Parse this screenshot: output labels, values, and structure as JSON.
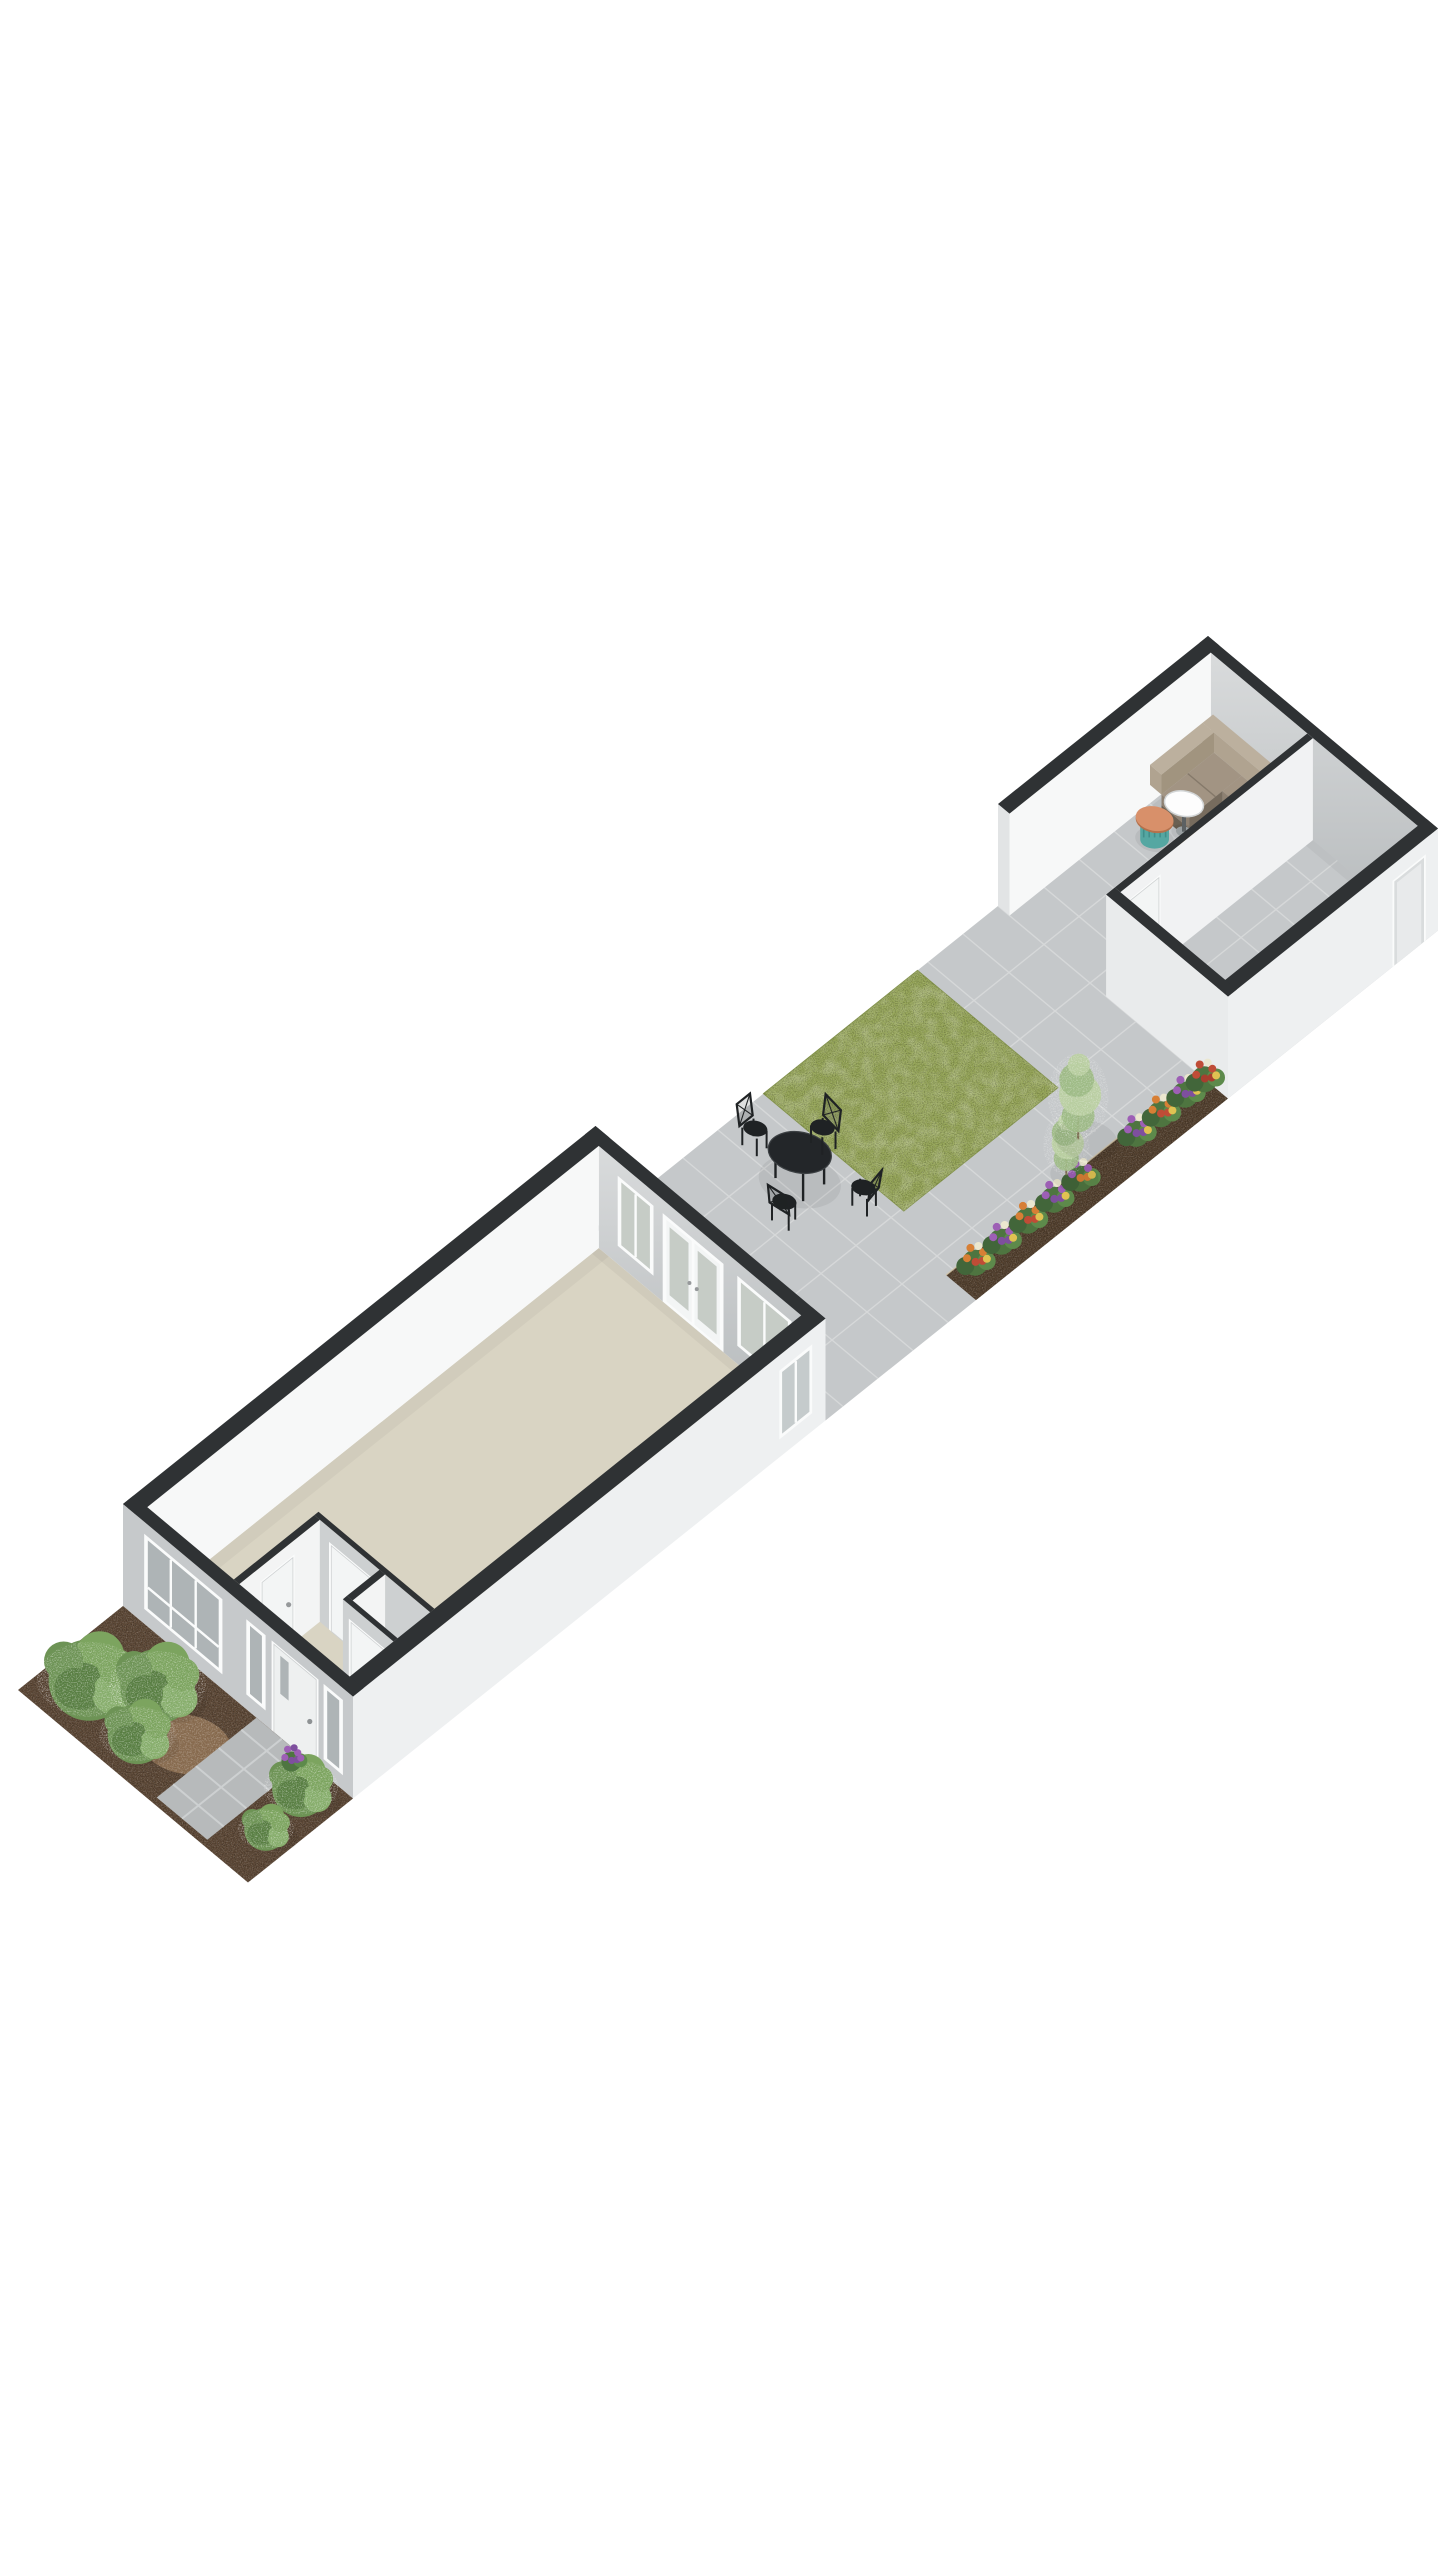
{
  "scene": {
    "background": "#ffffff",
    "projection": {
      "ux": 35,
      "uy": -28,
      "vx": 46,
      "vy": 38.5,
      "hz": 40,
      "ox": 18,
      "oy": 1690,
      "discRx": 58,
      "discRy": 37,
      "discRot": 11
    },
    "render": {
      "wallHeight": 2.55,
      "extWall": 0.3,
      "intWall": 0.12,
      "ghWall": 0.25
    },
    "palette": {
      "cap": "#2f3234",
      "faceFront": "#c6c9cb",
      "faceWhite": "#f7f8f8",
      "faceExt": "#eef0f1",
      "faceEnd": "#e2e4e5",
      "faceGrayInt": "#cdd0d1",
      "wallGradTop": "#d9dbdc",
      "wallGradBot": "#b6babc",
      "frame": "#fafbfb",
      "doorWhite": "#f3f5f5",
      "glass": "#c5cbcc",
      "glassDark": "#aeb4b6",
      "glassGarden": "#c6ccc6",
      "beige": "#d9d4c3",
      "tile": "#c5c8ca",
      "tileJoint": "#d6d8d9",
      "path": "#b7babb",
      "pathJoint": "#cdd0d1",
      "grass": "#95a557",
      "grassEdge": "#83934a",
      "soil": "#5d4836",
      "bedSoil": "#53402e",
      "bedEdge": "#d6c8ab",
      "mulch": "#8d6f50",
      "metal": "#1f2224",
      "tableTop": "#232629",
      "tableRim": "#3c4043",
      "sofaBack": "#b0a390",
      "sofaBackTop": "#bcb09e",
      "sofaBackIn": "#a1947f",
      "sofaSeat": "#a29483",
      "sofaSeatFront": "#8e8172",
      "sofaFrontDark": "#6a6052",
      "sofaSide": "#776c5e",
      "sofaGap": "#85796a",
      "woodTop": "#cfa76e",
      "woodSide": "#b18a52",
      "woodDark": "#8f6f3c",
      "woodShelf": "#c39c60",
      "teal": "#55a7a2",
      "tealDark": "#418e8a",
      "terracotta": "#d8906a",
      "terracottaSide": "#b3714c",
      "white": "#fdfdfd",
      "stem": "#5c6163",
      "greens": [
        "#6d9355",
        "#7ca45f",
        "#587e42",
        "#86ad6b"
      ],
      "sage": "#b9cfa0",
      "sageDark": "#9cb983",
      "leaf": "#4e7540",
      "leafLight": "#5d8a4b",
      "leafDark": "#42663a",
      "flowerPurple": "#9d5fb5",
      "flowerViolet": "#7e4f9e",
      "flowerOrange": "#d77f35",
      "flowerRed": "#bf4c36",
      "flowerWhite": "#ebe7cf",
      "flowerYellow": "#e0c252",
      "shadow": "rgba(0,0,0,0.06)"
    },
    "ground": {
      "patio": {
        "s": [
          16.5,
          34
        ],
        "t": [
          0,
          5
        ],
        "tileStep": 1
      },
      "lawn": {
        "s": [
          21.3,
          25.7
        ],
        "t": [
          0,
          3.05
        ]
      },
      "flowerBed": {
        "s": [
          20.8,
          28
        ],
        "t": [
          4.35,
          5
        ]
      },
      "frontGarden": {
        "s": [
          0,
          3
        ],
        "t": [
          0,
          5
        ]
      },
      "frontPath": {
        "s": [
          0.15,
          3
        ],
        "t": [
          2.9,
          4.0
        ],
        "joints": [
          0.62,
          1.27,
          1.92,
          2.57
        ],
        "midJoint": 3.45
      }
    },
    "house": {
      "shell": {
        "s": [
          3,
          16.5
        ],
        "t": [
          0,
          5
        ]
      },
      "rearOpenings": {
        "window1": {
          "t": [
            0.75,
            1.45
          ],
          "h": [
            0.5,
            2.15
          ],
          "mull": [
            1.1
          ]
        },
        "frenchDoors": {
          "t": [
            1.75,
            2.95
          ],
          "h": [
            0,
            2.15
          ]
        },
        "window2": {
          "t": [
            3.35,
            4.45
          ],
          "h": [
            0.5,
            2.15
          ],
          "mull": [
            3.9
          ]
        }
      },
      "facadeOpenings": {
        "bigWindow": {
          "t": [
            0.5,
            2.12
          ],
          "h": [
            0.42,
            2.2
          ],
          "mull": [
            1.04,
            1.58
          ],
          "rail": 0.98
        },
        "sidelight": {
          "t": [
            2.72,
            3.06
          ],
          "h": [
            0.42,
            2.2
          ]
        },
        "frontDoor": {
          "t": [
            3.28,
            4.2
          ],
          "h": [
            0,
            2.2
          ]
        },
        "narrowWindow": {
          "t": [
            4.4,
            4.74
          ],
          "h": [
            0.42,
            2.2
          ]
        }
      },
      "sideWindow": {
        "s": [
          15.22,
          16.08
        ],
        "h": [
          0.5,
          2.12
        ],
        "mull": [
          15.65
        ]
      },
      "hall": {
        "wallA": {
          "t": 2.18,
          "s": [
            3.3,
            5.6
          ],
          "door": [
            3.95,
            4.83
          ]
        },
        "wallD": {
          "s": 5.6,
          "t": [
            2.18,
            4.7
          ],
          "door": [
            2.55,
            3.43
          ]
        },
        "closet": {
          "wallC1": {
            "s": 4.55,
            "t": [
              3.6,
              4.7
            ],
            "door": [
              3.78,
              4.48
            ]
          },
          "wallC2": {
            "t": 3.6,
            "s": [
              4.67,
              5.6
            ]
          }
        }
      }
    },
    "gardenHouse": {
      "shell": {
        "s": [
          28,
          34
        ],
        "t": [
          0,
          5
        ]
      },
      "partition": {
        "t": 2.35,
        "door": [
          28.5,
          29.35
        ]
      },
      "frontWall": {
        "t": [
          2.35,
          5
        ]
      },
      "sideDoor": {
        "s": [
          32.75,
          33.6
        ],
        "h": [
          0,
          2.1
        ]
      }
    },
    "furniture": {
      "cornerSofa": {
        "longArm": {
          "s": [
            32.9,
            33.75
          ],
          "t": [
            0.3,
            2.3
          ]
        },
        "shortArm": {
          "s": [
            31.95,
            33.45
          ],
          "t": [
            0.3,
            1.15
          ]
        },
        "seatH": 0.55,
        "backH": 1.05,
        "backDepth": 0.3
      },
      "coffeeTable": {
        "s": [
          31.45,
          32.05
        ],
        "t": [
          1.25,
          2.3
        ],
        "h": 0.42
      },
      "pedestalTable": {
        "at": [
          32.0,
          1.0
        ],
        "r": 0.34,
        "h": 0.72
      },
      "drumTable": {
        "at": [
          31.45,
          0.78
        ],
        "r": 0.27,
        "h": 0.47
      },
      "bistroTable": {
        "at": [
          20.3,
          1.55
        ],
        "r": 0.55,
        "h": 0.72
      },
      "bistroChairs": [
        {
          "at": [
            20.25,
            0.62
          ],
          "out": [
            0,
            -1
          ]
        },
        {
          "at": [
            21.25,
            1.32
          ],
          "out": [
            1,
            0.15
          ]
        },
        {
          "at": [
            20.8,
            2.55
          ],
          "out": [
            0.15,
            1
          ]
        },
        {
          "at": [
            19.4,
            1.9
          ],
          "out": [
            -1,
            0.2
          ]
        }
      ]
    },
    "planting": {
      "frontBushes": [
        {
          "at": [
            1.05,
            0.75
          ],
          "r": 0.85
        },
        {
          "at": [
            1.95,
            1.55
          ],
          "r": 0.78
        },
        {
          "at": [
            0.85,
            1.95
          ],
          "r": 0.62
        },
        {
          "at": [
            2.3,
            4.4
          ],
          "r": 0.6
        },
        {
          "at": [
            1.1,
            4.55
          ],
          "r": 0.45
        }
      ],
      "frontAccent": {
        "at": [
          2.62,
          3.95
        ]
      },
      "mulchPatch": {
        "at": [
          1.5,
          2.5
        ],
        "r": 0.8
      },
      "bedFlowerRowT": 4.6,
      "bedFlowers": [
        {
          "s": 21.3,
          "kind": "orange"
        },
        {
          "s": 22.05,
          "kind": "purple"
        },
        {
          "s": 22.8,
          "kind": "orange"
        },
        {
          "s": 23.55,
          "kind": "purple"
        },
        {
          "s": 24.3,
          "kind": "mixed"
        },
        {
          "s": 25.9,
          "kind": "purple"
        },
        {
          "s": 26.6,
          "kind": "orange"
        },
        {
          "s": 27.3,
          "kind": "purple"
        },
        {
          "s": 27.85,
          "kind": "red"
        }
      ],
      "bedShrubs": [
        {
          "at": [
            24.3,
            4.3
          ],
          "r": 0.42,
          "hgt": 1.4
        },
        {
          "at": [
            25.1,
            3.95
          ],
          "r": 0.55,
          "hgt": 1.95
        }
      ]
    }
  }
}
